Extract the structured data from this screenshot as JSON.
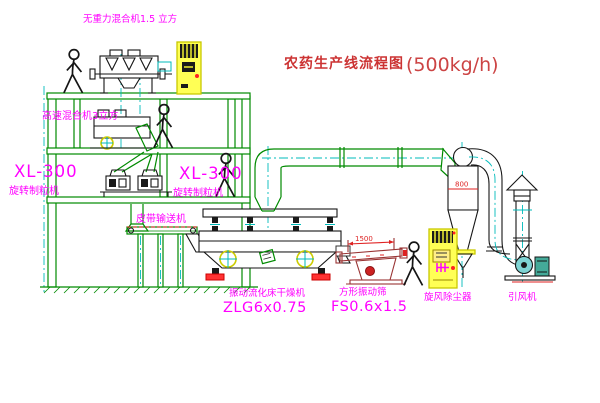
{
  "title": {
    "name": "农药生产线流程图",
    "capacity": "(500kg/h)"
  },
  "labels": {
    "gravity_free_mixer": "无重力混合机1.5 立方",
    "high_speed_mixer": "高速混合机3立方",
    "granulator_left_model": "XL-300",
    "granulator_left_name": "旋转制粒机",
    "granulator_right_model": "XL-300",
    "granulator_right_name": "旋转制粒机",
    "belt_conveyor": "皮带输送机",
    "dryer_name": "振动流化床干燥机",
    "dryer_model": "ZLG6x0.75",
    "sieve_name": "方形振动筛",
    "sieve_model": "FS0.6x1.5",
    "cyclone": "旋风除尘器",
    "fan": "引风机"
  },
  "dimensions": {
    "sieve_length": "1500",
    "cyclone_body": "800"
  },
  "colors": {
    "background": "#FFFFFF",
    "structure_green": "#008A00",
    "centerline_cyan": "#00BBBB",
    "label_magenta": "#FF00FF",
    "title_red": "#CC3333",
    "dimension_red": "#DD2222",
    "cabinet_yellow": "#FFFF55",
    "machine_black": "#151515"
  }
}
